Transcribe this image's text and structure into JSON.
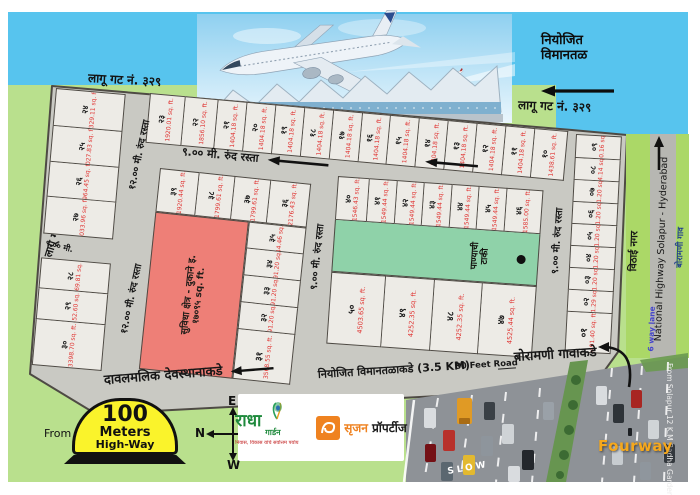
{
  "header": {
    "gat_329_left": "लागू गट नं. ३२९",
    "gat_329_right": "लागू गट नं. ३२९",
    "gat_333": "लागू गट नं. ३३३",
    "planned_airport_1": "नियोजित",
    "planned_airport_2": "विमानतळ"
  },
  "roads": {
    "road_9m": "९.०० मी. रुंद रस्ता",
    "road_9m_short": "९.०० मी.",
    "road_12m": "१२.०० मी. रुंद रस्ता",
    "davalmalik": "दावलमलिक देवस्थानाकडे",
    "airport_3_5km": "नियोजित विमानतळाकडे (3.5 KM)",
    "feet80": "80 Feet Road",
    "boramani_gavakade": "बोरामणी गावाकडे"
  },
  "features": {
    "suvidha_title": "सुविधा क्षेत्र - दुकाने इ.",
    "suvidha_area": "१७०९५ sq. ft.",
    "water_tank_1": "पाण्याची",
    "water_tank_2": "टाकी",
    "vithai_nagar": "विठाई नगर"
  },
  "highway": {
    "six_way_lane": "6 way lane",
    "national_highway": "National Highway Solapur - Hyderabad",
    "boramani_gav": "बोरामणी गाव",
    "fourway": "Fourway",
    "photo_caption": "From Solapur 12 K.M Radha Garden",
    "slow": "SLOW"
  },
  "legend": {
    "from": "From",
    "milestone_1": "100",
    "milestone_2": "Meters",
    "milestone_3": "High-Way",
    "compass": {
      "top": "E",
      "right": "S",
      "bottom": "W",
      "left": "N"
    }
  },
  "logos": {
    "radha_main": "राधा",
    "radha_sub": "गार्डन",
    "radha_tagline": "निवास, विकास यांचे सर्वोत्तम पर्याय",
    "srujan_name": "सृजन",
    "srujan_type": "प्रॉपर्टीज"
  },
  "colors": {
    "sky": "#57c4ee",
    "ground": "#b9e08d",
    "road": "#c9c9c3",
    "plot_fill": "#edebe6",
    "suvidha_pink": "#ee7f77",
    "tank_green": "#8fd2a9",
    "area_red": "#e03230",
    "strip_green": "#abd867",
    "highway_gray": "#b7b7b2",
    "milestone_yellow": "#faf32b"
  },
  "plots": {
    "left_top": [
      {
        "no": "२४",
        "area": "2329.11 sq. ft."
      },
      {
        "no": "२५",
        "area": "2027.83 sq. ft."
      },
      {
        "no": "२६",
        "area": "1964.45 sq. ft."
      },
      {
        "no": "२७",
        "area": "2033.96 sq. ft."
      }
    ],
    "left_bottom": [
      {
        "no": "२८",
        "area": "1469.81 sq. ft."
      },
      {
        "no": "२९",
        "area": "1452.60 sq. ft."
      },
      {
        "no": "३०",
        "area": "3398.70 sq. ft."
      }
    ],
    "top_row": [
      {
        "no": "२३",
        "area": "1920.01 sq. ft."
      },
      {
        "no": "२२",
        "area": "1856.10 sq. ft."
      },
      {
        "no": "२१",
        "area": "1404.18 sq. ft."
      },
      {
        "no": "२०",
        "area": "1404.18 sq. ft."
      },
      {
        "no": "१९",
        "area": "1404.18 sq. ft."
      },
      {
        "no": "१८",
        "area": "1404.18 sq. ft."
      },
      {
        "no": "१७",
        "area": "1404.18 sq. ft."
      },
      {
        "no": "१६",
        "area": "1404.18 sq. ft."
      },
      {
        "no": "१५",
        "area": "1404.18 sq. ft."
      },
      {
        "no": "१४",
        "area": "1404.18 sq. ft."
      },
      {
        "no": "१३",
        "area": "1404.18 sq. ft."
      },
      {
        "no": "१२",
        "area": "1404.18 sq. ft."
      },
      {
        "no": "११",
        "area": "1404.18 sq. ft."
      },
      {
        "no": "१०",
        "area": "1438.61 sq. ft."
      }
    ],
    "midleft_top": [
      {
        "no": "३९",
        "area": "1920.44 sq. ft."
      },
      {
        "no": "३८",
        "area": "1799.61 sq. ft."
      },
      {
        "no": "३७",
        "area": "1799.61 sq. ft."
      },
      {
        "no": "३६",
        "area": "2176.43 sq. ft."
      }
    ],
    "midleft_side": [
      {
        "no": "३५",
        "area": "1344.46 sq. ft."
      },
      {
        "no": "३४",
        "area": "1291.20 sq. ft."
      },
      {
        "no": "३३",
        "area": "1291.20 sq. ft."
      },
      {
        "no": "३२",
        "area": "1291.20 sq. ft."
      },
      {
        "no": "३१",
        "area": "3568.55 sq. ft."
      }
    ],
    "midright_top": [
      {
        "no": "४०",
        "area": "1546.43 sq. ft."
      },
      {
        "no": "४१",
        "area": "1549.44 sq. ft."
      },
      {
        "no": "४२",
        "area": "1549.44 sq. ft."
      },
      {
        "no": "४३",
        "area": "1549.44 sq. ft."
      },
      {
        "no": "४४",
        "area": "1549.44 sq. ft."
      },
      {
        "no": "४५",
        "area": "1549.44 sq. ft."
      },
      {
        "no": "४६",
        "area": "1585.00 sq. ft."
      }
    ],
    "midright_bottom": [
      {
        "no": "५०",
        "area": "4503.65 sq. ft."
      },
      {
        "no": "४९",
        "area": "4252.35 sq. ft."
      },
      {
        "no": "४८",
        "area": "4252.35 sq. ft."
      },
      {
        "no": "४७",
        "area": "4525.44 sq. ft."
      }
    ],
    "right_col": [
      {
        "no": "०९",
        "area": "1340.16 sq. ft."
      },
      {
        "no": "०८",
        "area": "1344.14 sq. ft."
      },
      {
        "no": "०७",
        "area": "1291.20 sq. ft."
      },
      {
        "no": "०६",
        "area": "1291.20 sq. ft."
      },
      {
        "no": "०५",
        "area": "1291.20 sq. ft."
      },
      {
        "no": "०४",
        "area": "1291.20 sq. ft."
      },
      {
        "no": "०३",
        "area": "1291.20 sq. ft."
      },
      {
        "no": "०२",
        "area": "1291.29 sq. ft."
      },
      {
        "no": "०१",
        "area": "3491.40 sq. ft."
      }
    ]
  }
}
